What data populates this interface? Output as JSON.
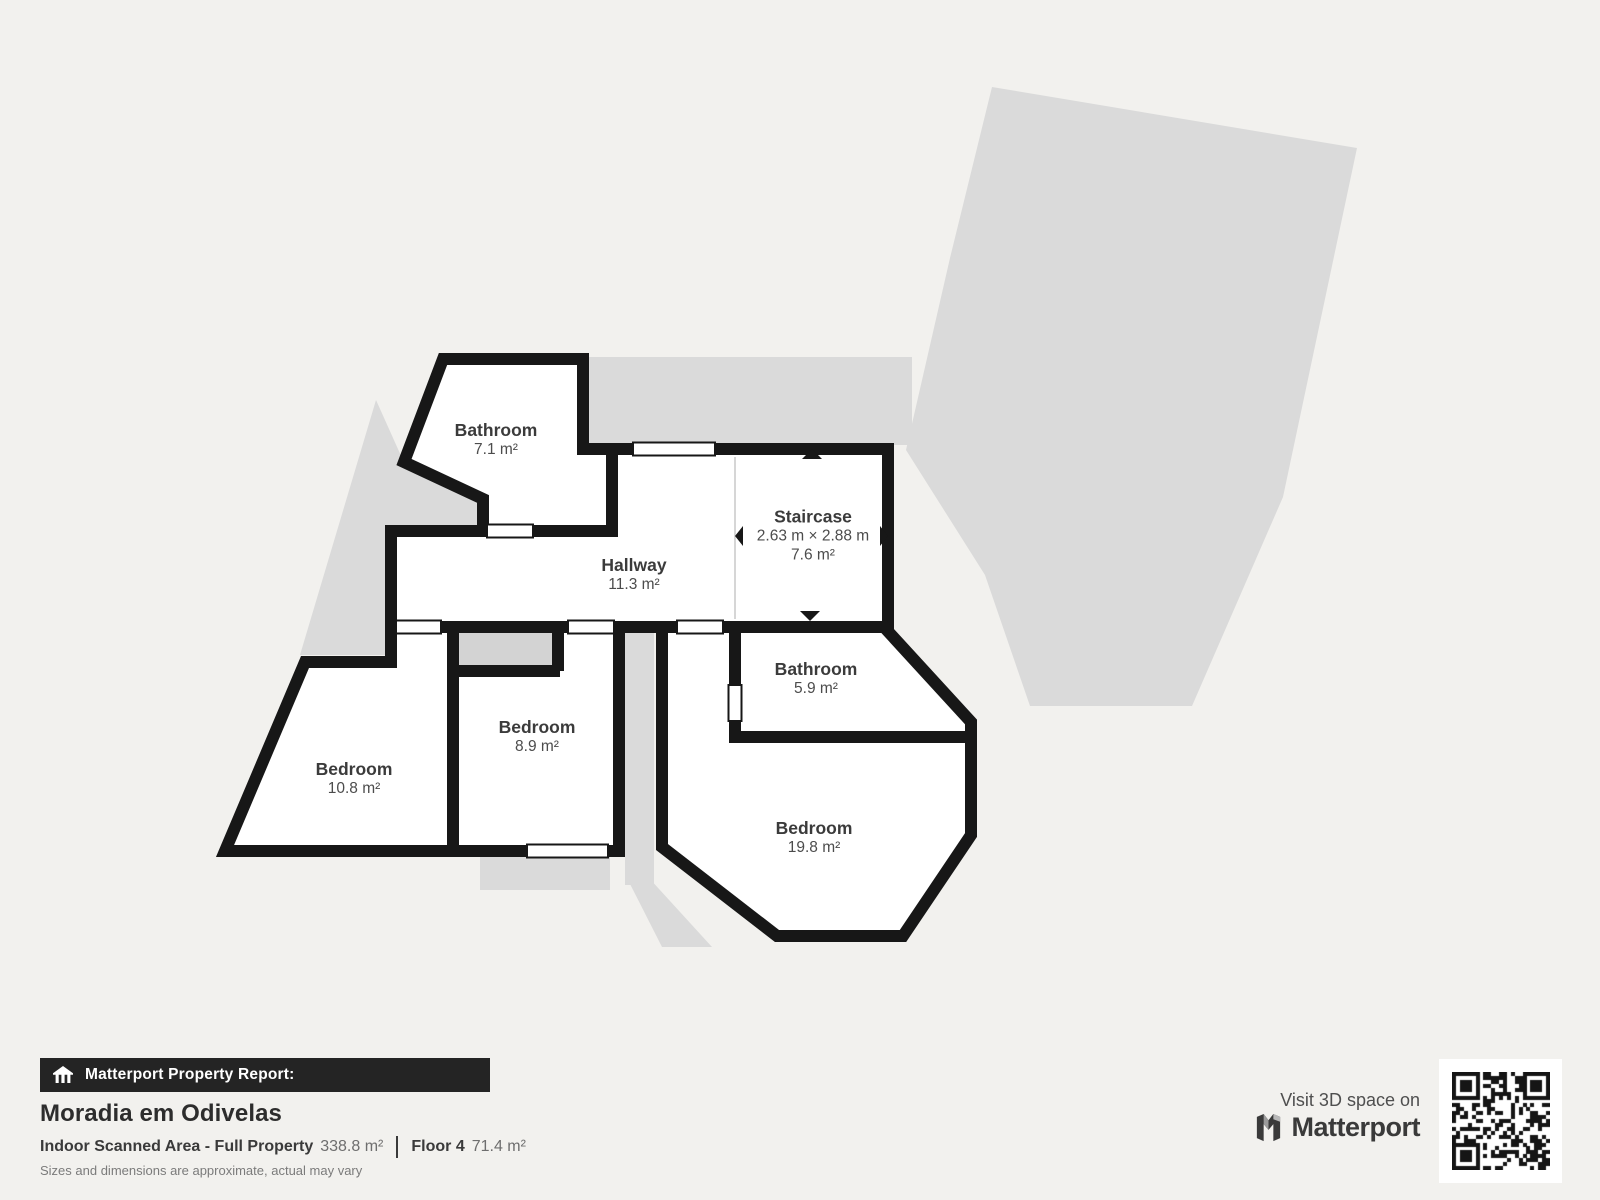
{
  "page": {
    "background_color": "#f2f1ee",
    "shadow_color": "#dadada",
    "wall_color": "#171717",
    "room_fill_color": "#ffffff",
    "footer_bar_color": "#242424"
  },
  "floorplan": {
    "rooms": [
      {
        "name": "Bathroom",
        "area": "7.1 m²"
      },
      {
        "name": "Hallway",
        "area": "11.3 m²"
      },
      {
        "name": "Staircase",
        "dims": "2.63 m × 2.88 m",
        "area": "7.6 m²"
      },
      {
        "name": "Bathroom",
        "area": "5.9 m²"
      },
      {
        "name": "Bedroom",
        "area": "8.9 m²"
      },
      {
        "name": "Bedroom",
        "area": "10.8 m²"
      },
      {
        "name": "Bedroom",
        "area": "19.8 m²"
      }
    ]
  },
  "footer": {
    "report_label": "Matterport Property Report:",
    "property_name": "Moradia em Odivelas",
    "scanned_area_label": "Indoor Scanned Area - Full Property",
    "scanned_area_value": "338.8 m²",
    "floor_label": "Floor 4",
    "floor_value": "71.4 m²",
    "disclaimer": "Sizes and dimensions are approximate, actual may vary",
    "visit_label": "Visit 3D space on",
    "brand": "Matterport"
  }
}
